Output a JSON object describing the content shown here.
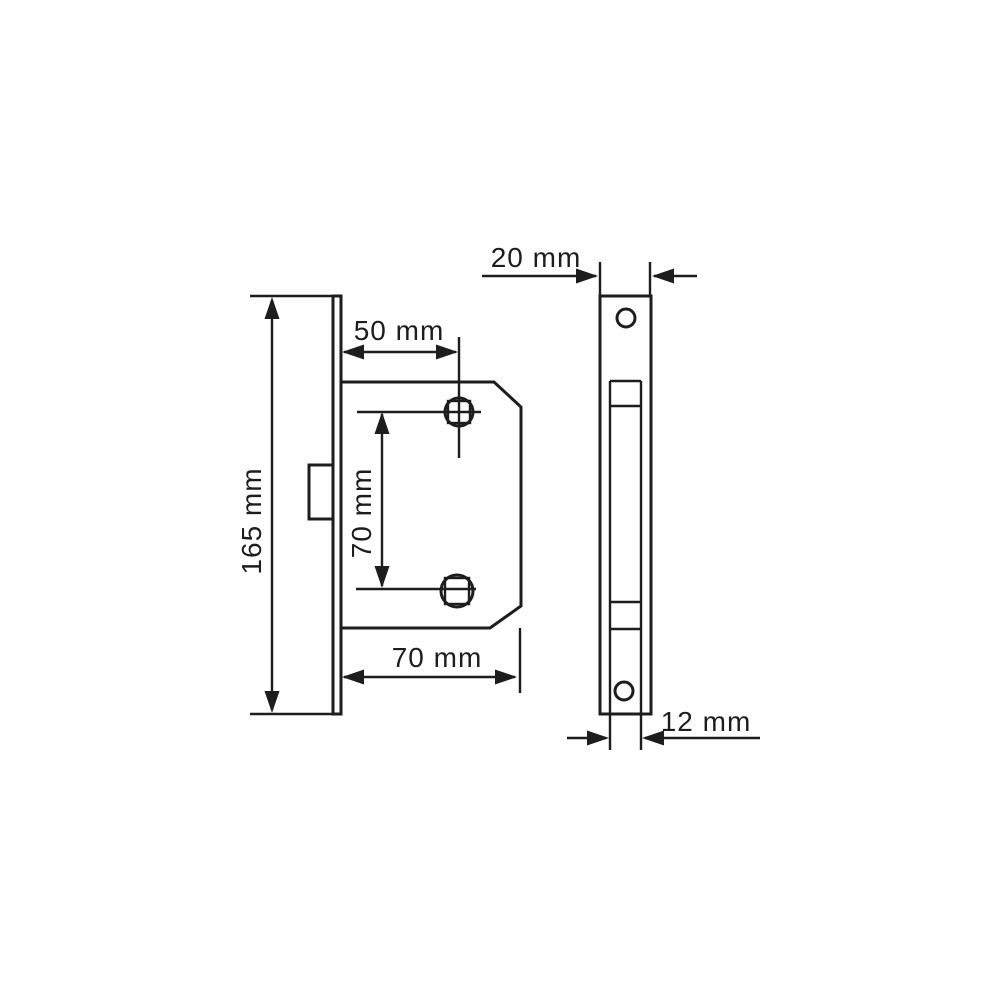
{
  "drawing": {
    "background_color": "#fefefe",
    "line_color": "#1d1d1d",
    "views": {
      "side_view_name": "lock-side-view",
      "front_view_name": "faceplate-front-view"
    },
    "labels": {
      "plate_height": "165 mm",
      "backset": "50 mm",
      "spindle_spacing": "70 mm",
      "case_depth": "70 mm",
      "plate_width": "20 mm",
      "case_thickness": "12 mm"
    }
  }
}
